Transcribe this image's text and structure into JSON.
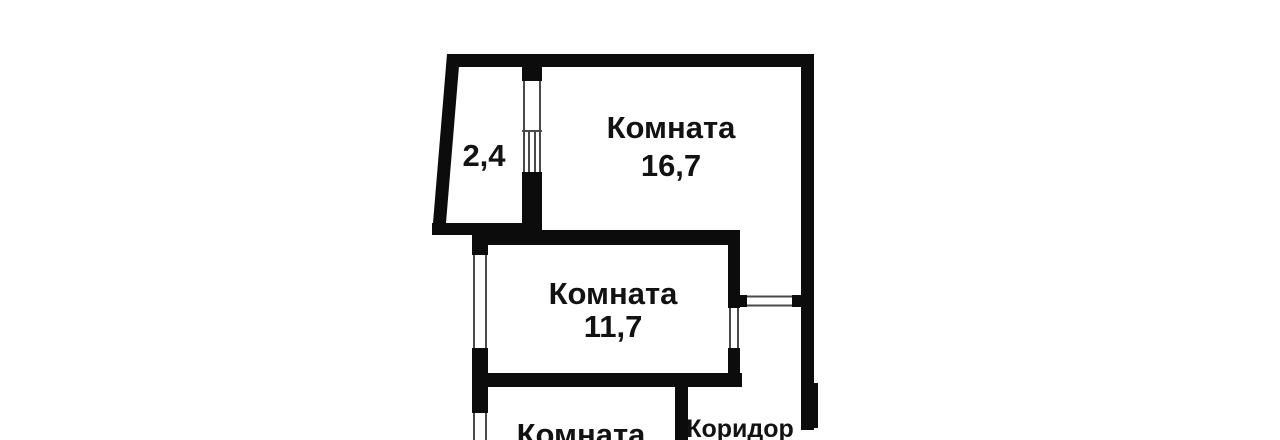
{
  "colors": {
    "background": "#ffffff",
    "wall": "#0c0c0c",
    "window_line": "#4a4a4a",
    "text": "#121212"
  },
  "floorplan": {
    "balcony": {
      "area": "2,4"
    },
    "room_top": {
      "name": "Комната",
      "area": "16,7"
    },
    "room_middle": {
      "name": "Комната",
      "area": "11,7"
    },
    "room_bottom": {
      "name": "Комната"
    },
    "corridor": {
      "name": "Коридор"
    }
  }
}
